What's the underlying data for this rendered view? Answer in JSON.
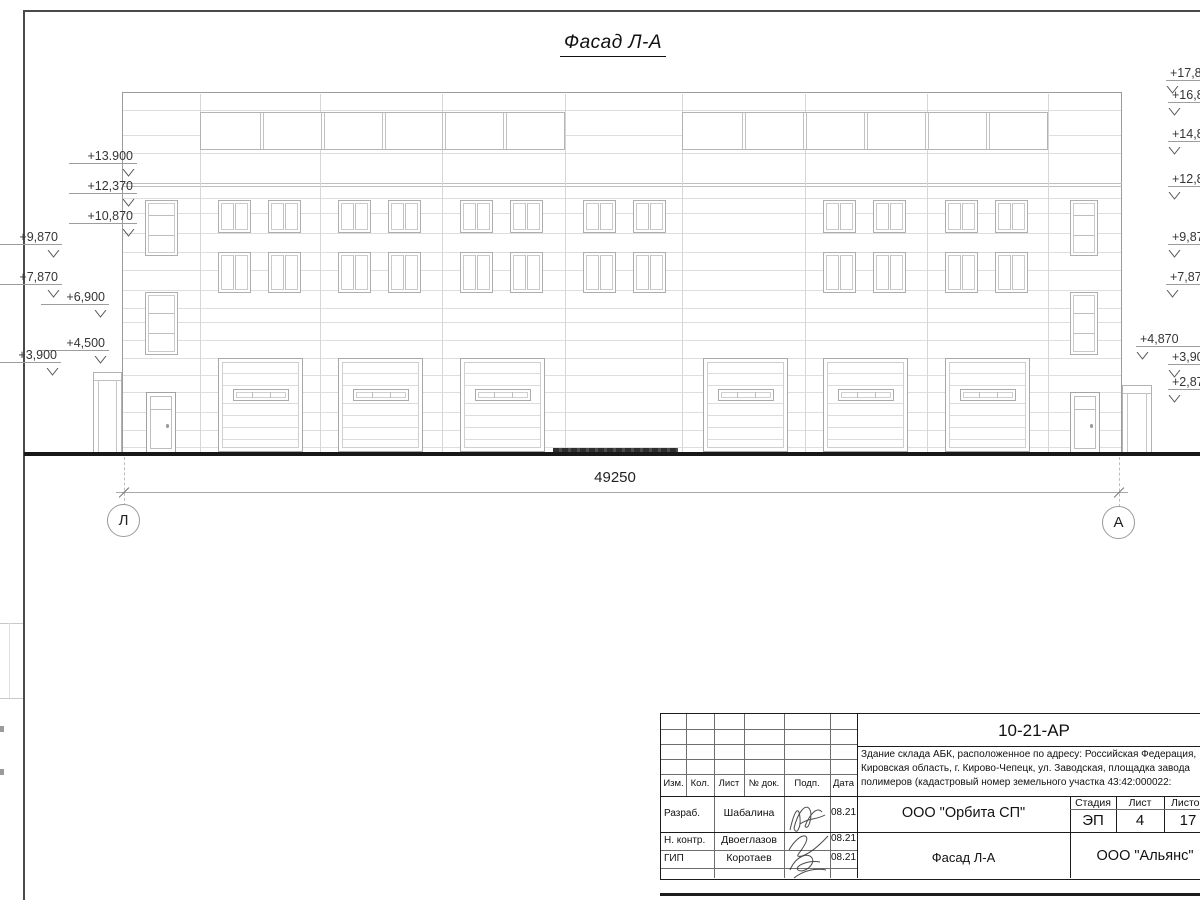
{
  "sheet": {
    "title": "Фасад Л-А",
    "dimension_total": "49250",
    "axis_left": "Л",
    "axis_right": "А"
  },
  "elevations": {
    "left": [
      {
        "label": "+13.900"
      },
      {
        "label": "+12,370"
      },
      {
        "label": "+10,870"
      },
      {
        "label": "+9,870"
      },
      {
        "label": "+7,870"
      },
      {
        "label": "+6,900"
      },
      {
        "label": "+4,500"
      },
      {
        "label": "+3,900"
      }
    ],
    "right": [
      {
        "label": "+17,870"
      },
      {
        "label": "+16,870"
      },
      {
        "label": "+14,870"
      },
      {
        "label": "+12,870"
      },
      {
        "label": "+9,870"
      },
      {
        "label": "+7,870"
      },
      {
        "label": "+4,870"
      },
      {
        "label": "+3,900"
      },
      {
        "label": "+2,870"
      }
    ]
  },
  "title_block": {
    "doc_number": "10-21-АР",
    "description_line1": "Здание склада АБК, расположенное по адресу: Российская Федерация,",
    "description_line2": "Кировская область, г. Кирово-Чепецк, ул. Заводская, площадка завода",
    "description_line3": "полимеров (кадастровый номер земельного участка 43:42:000022:",
    "col_izm": "Изм.",
    "col_kol": "Кол.",
    "col_list": "Лист",
    "col_doc": "№ док.",
    "col_podp": "Подп.",
    "col_data": "Дата",
    "rows": [
      {
        "role": "Разраб.",
        "name": "Шабалина",
        "date": "08.21"
      },
      {
        "role": "Н. контр.",
        "name": "Двоеглазов",
        "date": "08.21"
      },
      {
        "role": "ГИП",
        "name": "Коротаев",
        "date": "08.21"
      }
    ],
    "org": "ООО \"Орбита СП\"",
    "stage_label": "Стадия",
    "sheet_label": "Лист",
    "sheets_label": "Листов",
    "stage": "ЭП",
    "sheet_no": "4",
    "sheets_total": "17",
    "drawing_name": "Фасад Л-А",
    "contractor": "ООО \"Альянс\""
  }
}
